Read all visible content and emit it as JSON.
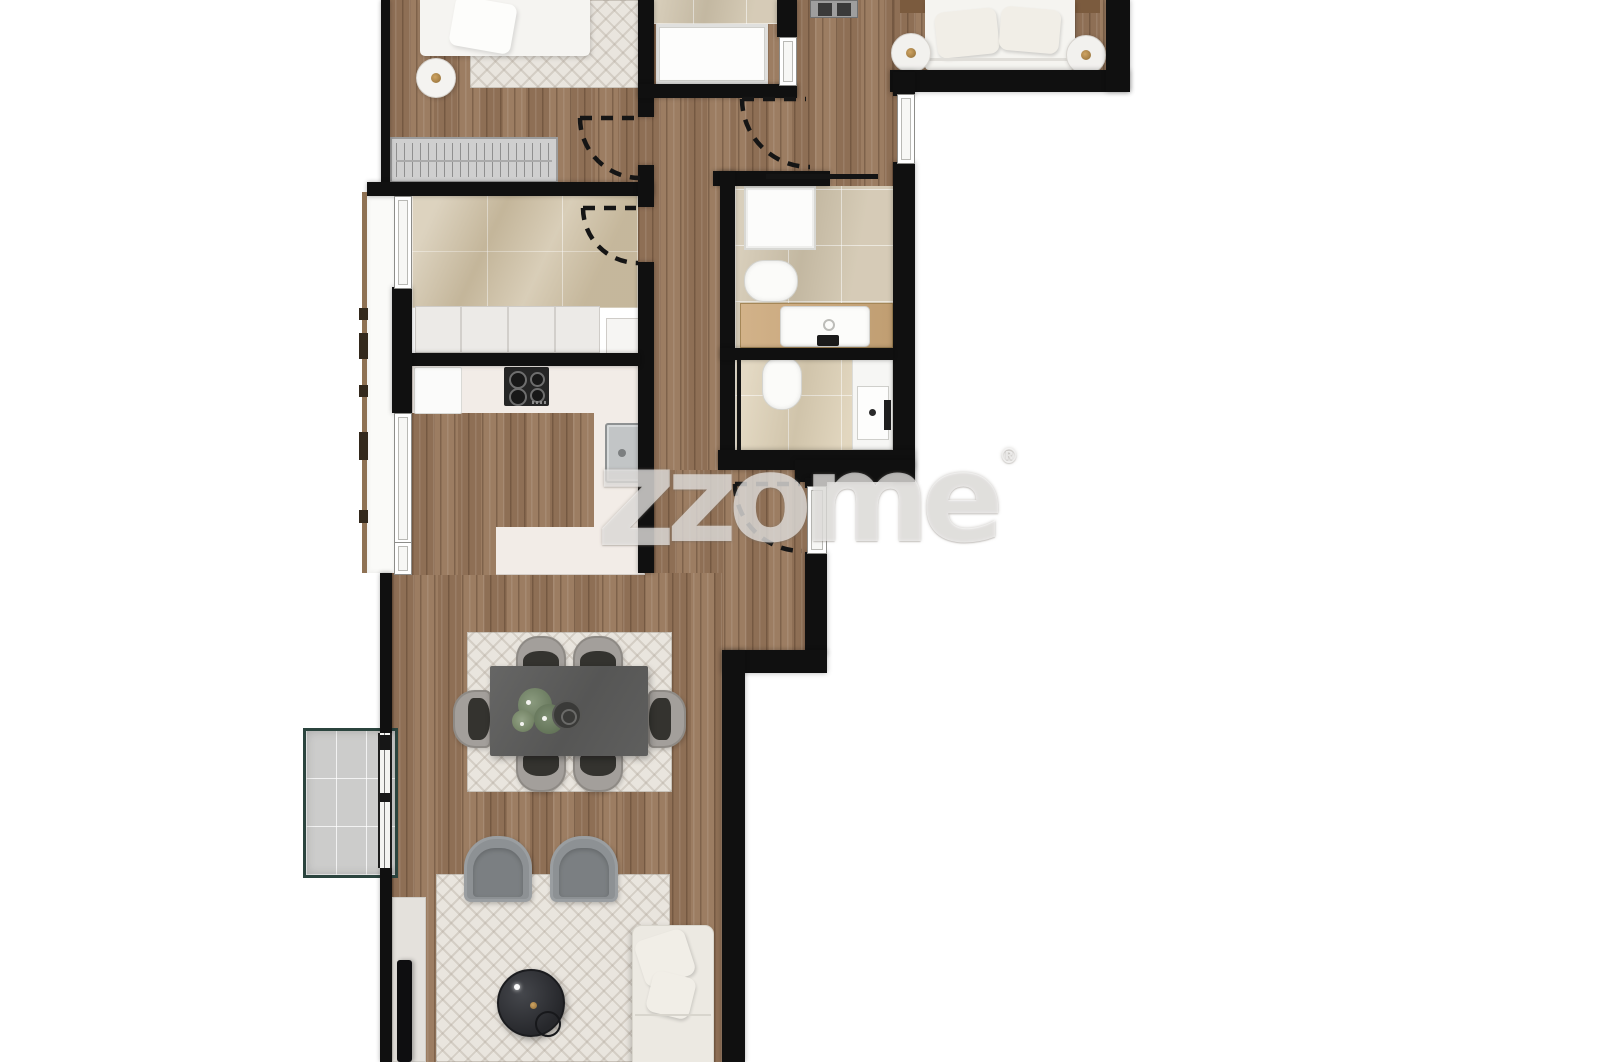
{
  "watermark": {
    "prefix": "z",
    "text": "zome",
    "registered_mark": "®"
  },
  "palette": {
    "wall": "#101010",
    "wood_floor": "#97765a",
    "bathroom_tile": "#cfc3ab",
    "bathroom_tile_light": "#ddd0b5",
    "laundry_marble": "#cec0a4",
    "kitchen_counter": "#f2ece7",
    "rug": "#e9e5de",
    "balcony_border": "#2b443e",
    "balcony_floor": "#cccccb",
    "sofa_cream": "#ece9e2",
    "armchair_gray": "#8d9194",
    "dining_chair_gray": "#a39f9b",
    "dining_table_gray": "#5e5e5d",
    "coffee_table_dark": "#2b2c30",
    "vanity_wood": "#c9a87c",
    "accent_gold": "#a87c3f",
    "watermark_white": "#ffffff"
  },
  "rooms": [
    "bedroom-1",
    "bedroom-2",
    "shower-room",
    "bathroom-1",
    "bathroom-2",
    "laundry",
    "kitchen",
    "hallway",
    "entrance-hall",
    "dining-area",
    "living-area",
    "terrace",
    "balcony"
  ],
  "furniture": [
    "double-bed",
    "single-bed",
    "wardrobe",
    "nightstands",
    "shower-trays",
    "toilets",
    "washbasins",
    "vanity-counter",
    "cooktop",
    "kitchen-sink",
    "kitchen-counters",
    "dining-table",
    "six-dining-chairs",
    "dining-rug",
    "plant-centerpiece",
    "two-armchairs",
    "living-rug",
    "round-coffee-table",
    "sofa",
    "tv-sideboard",
    "tv"
  ]
}
